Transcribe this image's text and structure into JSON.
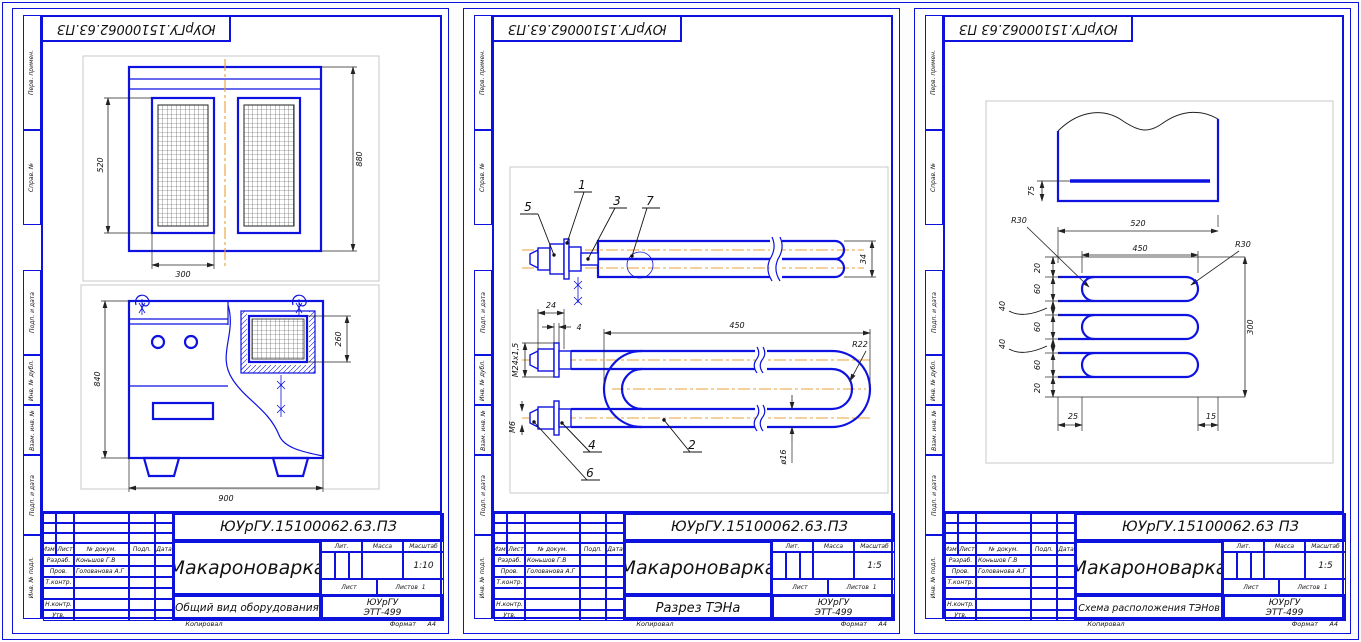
{
  "labels": {
    "margin": [
      "Перв. примен.",
      "Справ. №",
      "Подп. и дата",
      "Инв. № дубл.",
      "Взам. инв. №",
      "Подп. и дата",
      "Инв. № подл."
    ],
    "tb": {
      "izm": "Изм.",
      "list": "Лист",
      "ndok": "№ докум.",
      "podp": "Подп.",
      "data": "Дата",
      "razrab": "Разраб.",
      "prov": "Пров.",
      "tkontr": "Т.контр.",
      "nkontr": "Н.контр.",
      "utv": "Утв.",
      "lit": "Лит.",
      "massa": "Масса",
      "masshtab": "Масштаб",
      "list2": "Лист",
      "listov": "Листов",
      "listov_val": "1",
      "kopiroval": "Копировал",
      "format": "Формат",
      "format_val": "А4"
    }
  },
  "sheets": [
    {
      "stamp": "ЮУрГУ.15100062.63.ПЗ",
      "doc": "ЮУрГУ.15100062.63.ПЗ",
      "title": "Макароноварка",
      "subtitle": "Общий вид оборудования",
      "scale": "1:10",
      "org": "ЮУрГУ",
      "group": "ЭТТ-499",
      "razrab": "Коньшов Г.В",
      "prov": "Голованова А.Г"
    },
    {
      "stamp": "ЮУрГУ.15100062.63.ПЗ",
      "doc": "ЮУрГУ.15100062.63.ПЗ",
      "title": "Макароноварка",
      "subtitle": "Разрез ТЭНа",
      "scale": "1:5",
      "org": "ЮУрГУ",
      "group": "ЭТТ-499",
      "razrab": "Коньшов Г.В",
      "prov": "Голованова А.Г"
    },
    {
      "stamp": "ЮУрГУ.15100062.63 ПЗ",
      "doc": "ЮУрГУ.15100062.63 ПЗ",
      "title": "Макароноварка",
      "subtitle": "Схема расположения ТЭНов",
      "scale": "1:5",
      "org": "ЮУрГУ",
      "group": "ЭТТ-499",
      "razrab": "Коньшов Г.В",
      "prov": "Голованова А.Г"
    }
  ],
  "drawings": {
    "s1": {
      "d520": "520",
      "d880": "880",
      "d300": "300",
      "d840": "840",
      "d260": "260",
      "d900": "900"
    },
    "s2": {
      "n1": "1",
      "n2": "2",
      "n3": "3",
      "n4": "4",
      "n5": "5",
      "n6": "6",
      "n7": "7",
      "d34": "34",
      "m24": "М24х1,5",
      "d24": "24",
      "d4": "4",
      "d450": "450",
      "r22": "R22",
      "d16": "ø16",
      "m6": "М6"
    },
    "s3": {
      "d75": "75",
      "d520": "520",
      "d450": "450",
      "r30l": "R30",
      "r30r": "R30",
      "d20t": "20",
      "d60a": "60",
      "d40a": "40",
      "d60b": "60",
      "d40b": "40",
      "d60c": "60",
      "d20b": "20",
      "d300": "300",
      "d25": "25",
      "d15": "15"
    }
  },
  "colors": {
    "frame": "#0d12dd",
    "line": "#0d12e0",
    "centerline": "#e8a03a",
    "view_frame": "#c8c8c8",
    "dim": "#222222"
  }
}
